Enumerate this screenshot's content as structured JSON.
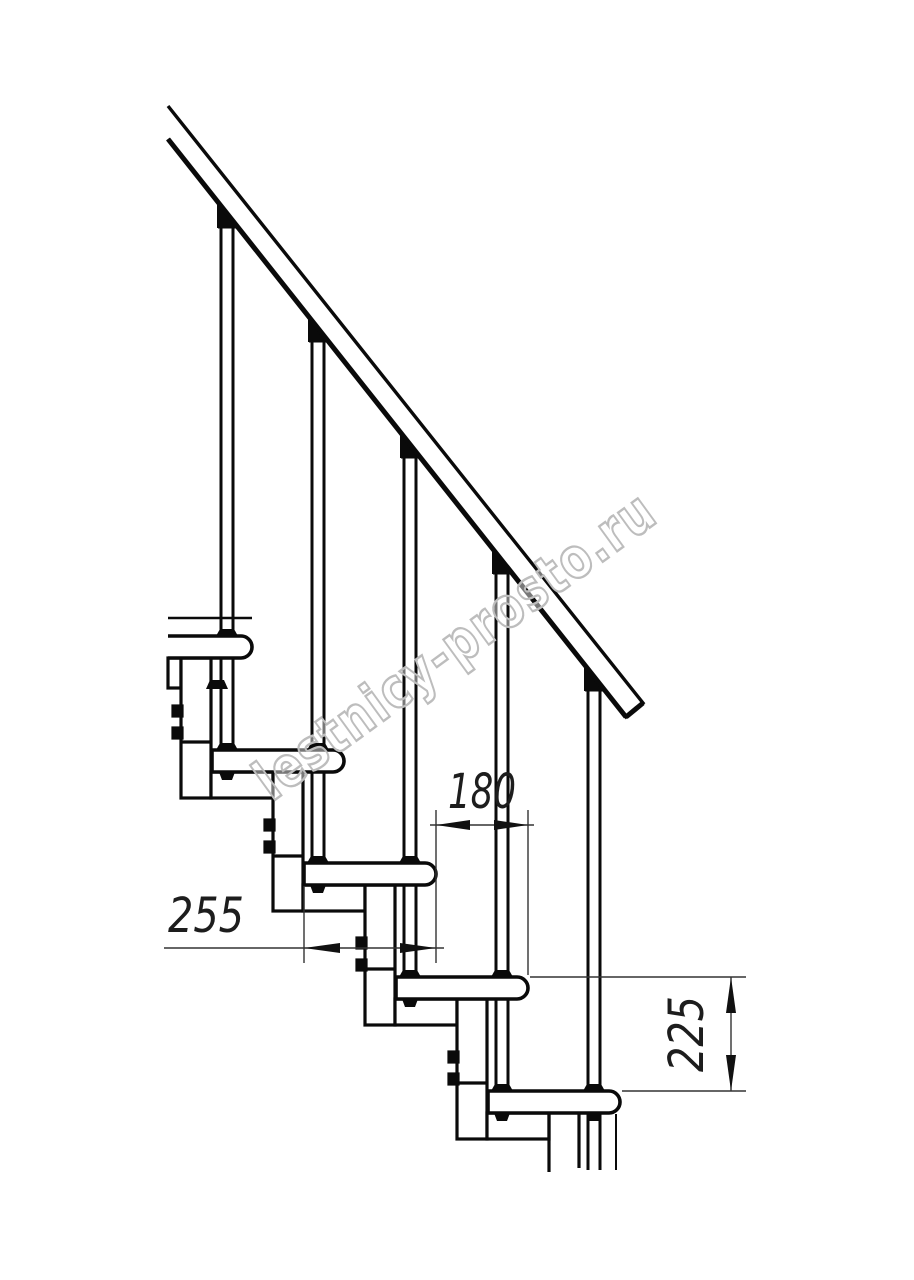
{
  "watermark": {
    "text": "lestnicy-prosto.ru"
  },
  "dimensions": {
    "tread_depth": "255",
    "step_run": "180",
    "step_height": "225"
  },
  "colors": {
    "ink": "#0a0a0a",
    "dim_line": "#333333",
    "watermark_stroke": "#bdbdbd",
    "background": "#ffffff"
  }
}
